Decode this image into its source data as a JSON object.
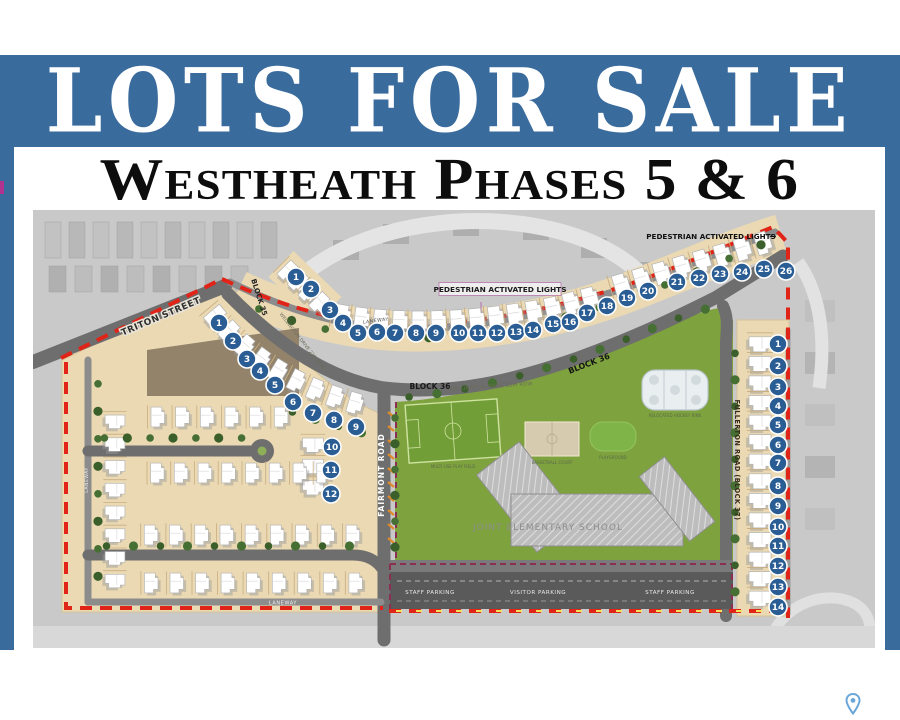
{
  "banner": {
    "title": "LOTS FOR SALE",
    "subtitle": "Westheath Phases 5 & 6",
    "accent_color": "#3a6b9d",
    "boundary_color": "#e02417",
    "lot_marker_color": "#2a5d94",
    "park_color": "#7ea23e",
    "lot_fill_color": "#ead9b3"
  },
  "map": {
    "streets": {
      "triton": "TRITON STREET",
      "fairmont": "FAIRMONT ROAD",
      "fullerton": "FULLERTON ROAD (BLOCK 37)",
      "wellington_mid": "WELLINGTON DRIVE 22M ROW",
      "wellington_curve": "WELLINGTON DRIVE 22M ROW",
      "laneway_top": "LANEWAY",
      "laneway_left": "LANEWAY",
      "laneway_bottom": "LANEWAY"
    },
    "blocks": {
      "block35": "BLOCK 35",
      "block36_a": "BLOCK 36",
      "block36_b": "BLOCK 36"
    },
    "signs": {
      "ped_mid": "PEDESTRIAN ACTIVATED LIGHTS",
      "ped_ne": "PEDESTRIAN ACTIVATED LIGHTS",
      "ped_ne_arrow": "→"
    },
    "places": {
      "school": "JOINT ELEMENTARY SCHOOL",
      "rink": "RELOCATED HOCKEY RINK",
      "field": "MULTI-USE PLAY FIELD",
      "court": "BASKETBALL COURT",
      "playground": "PLAYGROUND"
    },
    "parking": {
      "staff_w": "STAFF PARKING",
      "visitor": "VISITOR PARKING",
      "staff_e": "STAFF PARKING"
    },
    "lots": {
      "north": [
        "1",
        "2",
        "3",
        "4",
        "5",
        "6",
        "7",
        "8",
        "9",
        "10",
        "11",
        "12",
        "13",
        "14",
        "15",
        "16",
        "17",
        "18",
        "19",
        "20",
        "21",
        "22",
        "23",
        "24",
        "25",
        "26"
      ],
      "inner": [
        "1",
        "2",
        "3",
        "4",
        "5",
        "6",
        "7",
        "8",
        "9",
        "10",
        "11",
        "12"
      ],
      "east": [
        "1",
        "2",
        "3",
        "4",
        "5",
        "6",
        "7",
        "8",
        "9",
        "10",
        "11",
        "12",
        "13",
        "14"
      ]
    }
  }
}
